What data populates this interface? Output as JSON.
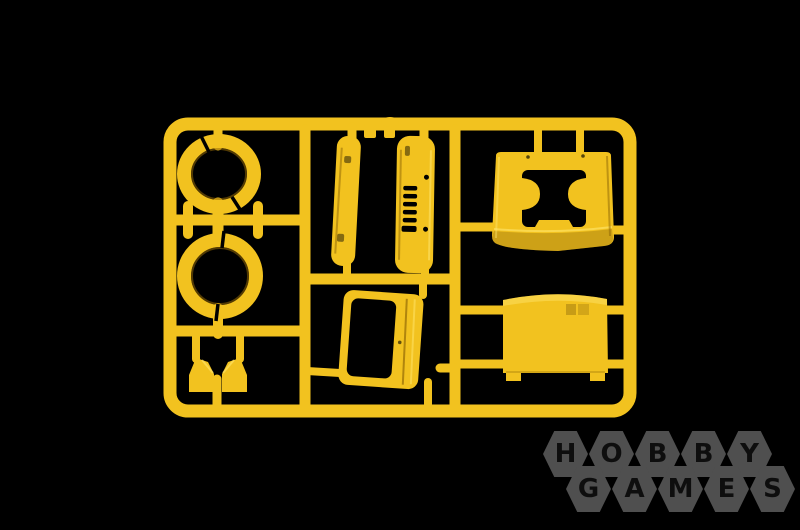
{
  "scene": {
    "description": "Product photo of a yellow injection-molded plastic model kit sprue (truck cab parts frame) on a black background",
    "background_color": "#000000"
  },
  "sprue": {
    "plastic_color": "#f2c21f",
    "highlight_color": "#ffdf5e",
    "shadow_color": "#b5860d",
    "parts": [
      {
        "name": "wheel-arch-ring-upper",
        "shape": "split ring made of two arcs"
      },
      {
        "name": "wheel-arch-ring-lower",
        "shape": "split ring made of two arcs"
      },
      {
        "name": "narrow-slab-panel",
        "shape": "long rounded slab"
      },
      {
        "name": "vented-slab-panel",
        "shape": "long rounded slab with vent slots"
      },
      {
        "name": "cab-rear-bulkhead",
        "shape": "saddle part with two walls and cutouts"
      },
      {
        "name": "cab-door",
        "shape": "tilted door with open window frame"
      },
      {
        "name": "roof-panel",
        "shape": "large arched rectangular panel with feet"
      },
      {
        "name": "wedge-part-left",
        "shape": "small angled wedge"
      },
      {
        "name": "wedge-part-right",
        "shape": "small angled wedge"
      }
    ]
  },
  "watermark": {
    "hexagon_color": "#4f4f4f",
    "letter_color": "#0e0e0e",
    "rows": [
      {
        "word": "HOBBY",
        "letters": [
          "H",
          "O",
          "B",
          "B",
          "Y"
        ]
      },
      {
        "word": "GAMES",
        "letters": [
          "G",
          "A",
          "M",
          "E",
          "S"
        ]
      }
    ]
  }
}
